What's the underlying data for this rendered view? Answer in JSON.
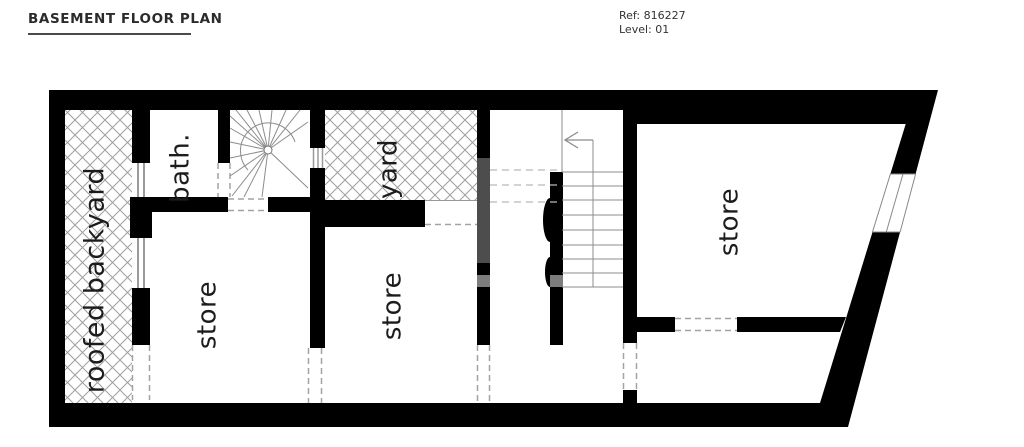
{
  "header": {
    "title": "BASEMENT FLOOR PLAN",
    "ref": "Ref: 816227",
    "level": "Level: 01"
  },
  "plan": {
    "rooms": [
      {
        "id": "roofed-backyard",
        "label": "roofed backyard"
      },
      {
        "id": "bath",
        "label": "bath."
      },
      {
        "id": "yard",
        "label": "yard"
      },
      {
        "id": "store-left",
        "label": "store"
      },
      {
        "id": "store-middle",
        "label": "store"
      },
      {
        "id": "store-right",
        "label": "store"
      }
    ],
    "colors": {
      "wall": "#000000",
      "hatch_line": "#9e9e9e",
      "gray_wall": "#4d4d4d",
      "gray_wall_light": "#7d7d7d",
      "dashed_opening": "#a3a3a3",
      "label_text": "#1c1c1c"
    }
  }
}
